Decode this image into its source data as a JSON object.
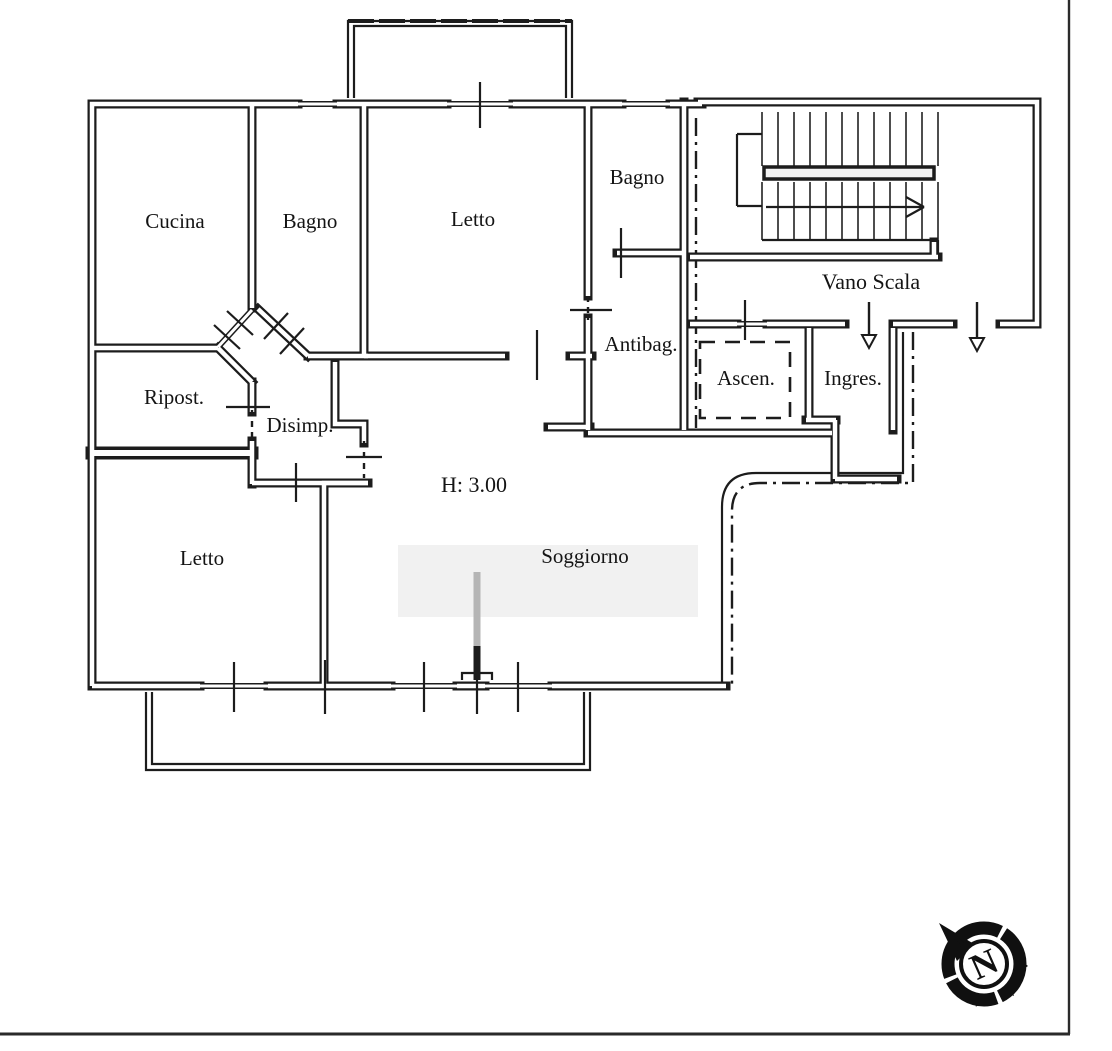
{
  "floorplan": {
    "rooms": [
      {
        "id": "cucina",
        "label": "Cucina"
      },
      {
        "id": "bagno-1",
        "label": "Bagno"
      },
      {
        "id": "letto-1",
        "label": "Letto"
      },
      {
        "id": "bagno-2",
        "label": "Bagno"
      },
      {
        "id": "antibagno",
        "label": "Antibag."
      },
      {
        "id": "vano-scala",
        "label": "Vano Scala"
      },
      {
        "id": "ascensore",
        "label": "Ascen."
      },
      {
        "id": "ingresso",
        "label": "Ingres."
      },
      {
        "id": "ripostiglio",
        "label": "Ripost."
      },
      {
        "id": "disimpegno",
        "label": "Disimp."
      },
      {
        "id": "letto-2",
        "label": "Letto"
      },
      {
        "id": "soggiorno",
        "label": "Soggiorno"
      }
    ],
    "annotations": [
      {
        "id": "ceiling-height",
        "label": "H: 3.00"
      }
    ],
    "compass": {
      "letter": "N"
    },
    "colors": {
      "line": "#1c1c1c",
      "paper": "#ffffff"
    }
  }
}
